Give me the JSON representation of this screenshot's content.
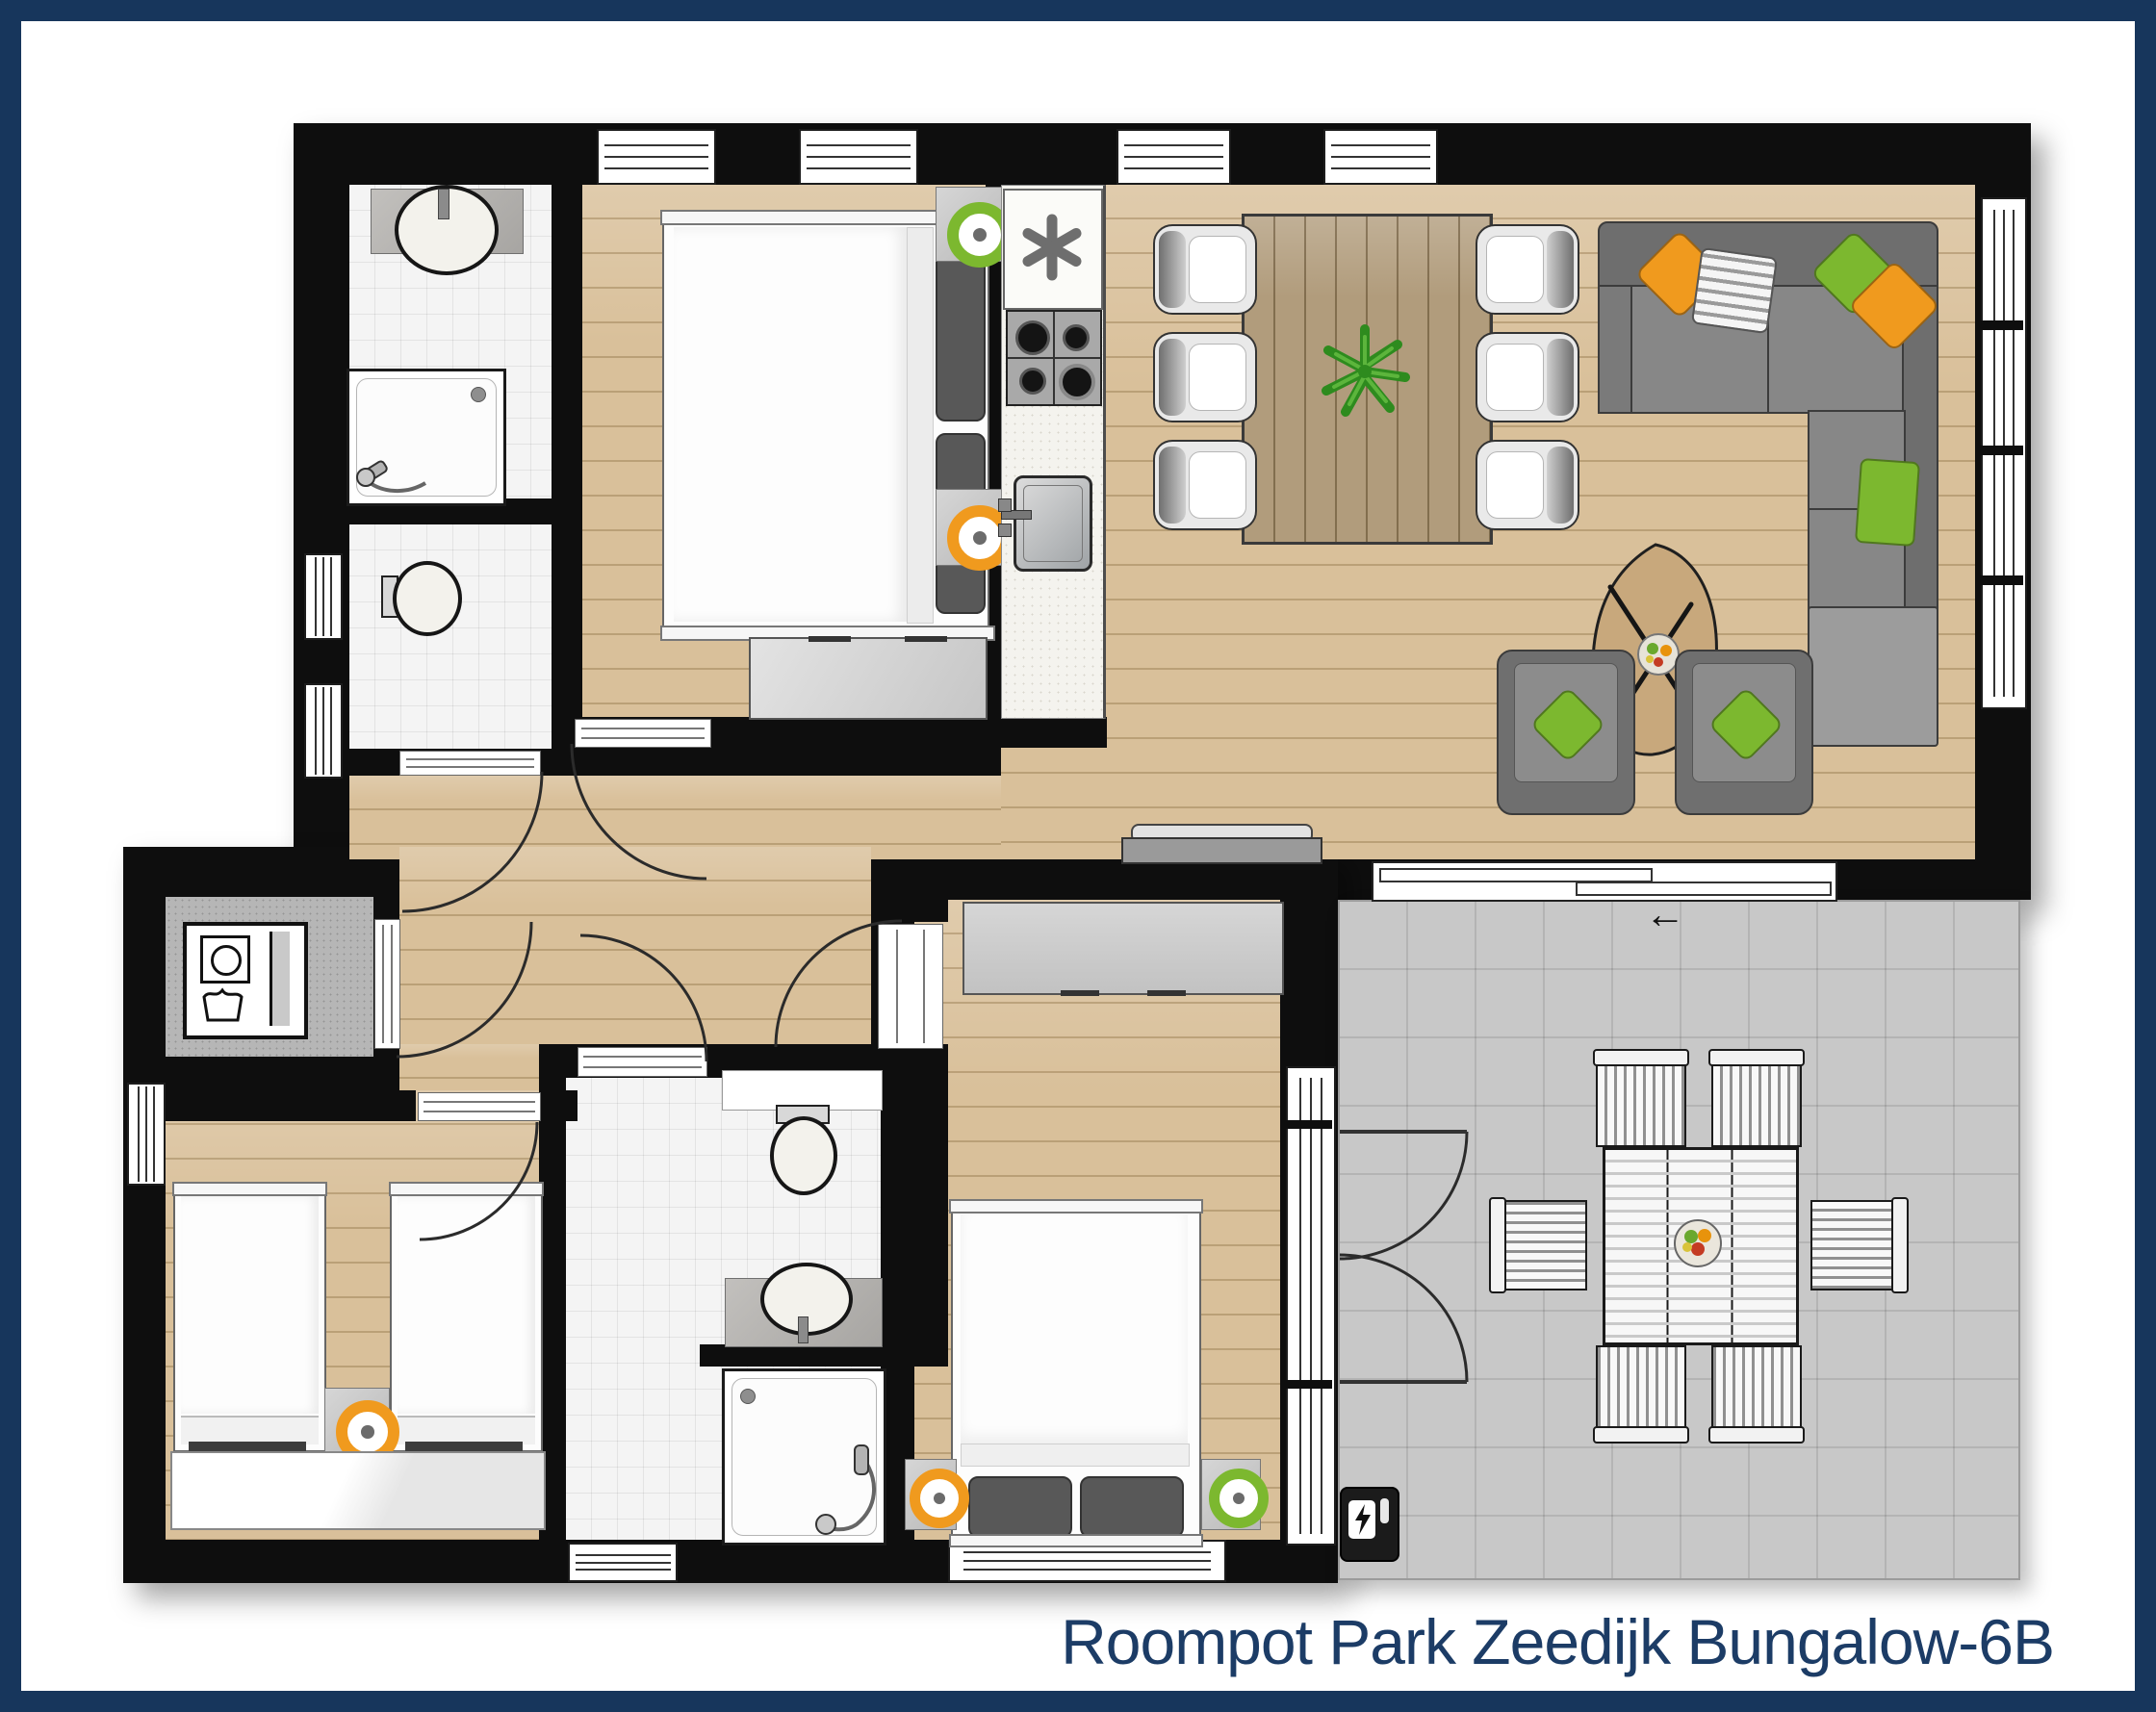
{
  "title": "Roompot Park Zeedijk Bungalow-6B",
  "colors": {
    "frame_navy": "#17365c",
    "title_text": "#1c3c66",
    "wall_black": "#0e0e0e",
    "wood_floor": "#d9c09a",
    "tile_floor": "#f4f4f4",
    "terrace_floor": "#c8c8c8",
    "utility_floor": "#b6b6b6",
    "sofa_gray": "#7d7d7d",
    "accent_green": "#7cb82f",
    "accent_orange": "#f09a1e",
    "table_wood": "#b19c7c"
  },
  "icons": {
    "freezer_icon": "six-spoke-asterisk",
    "charging_station_icon": "lightning-bolt",
    "slide_direction_arrow": "←"
  }
}
